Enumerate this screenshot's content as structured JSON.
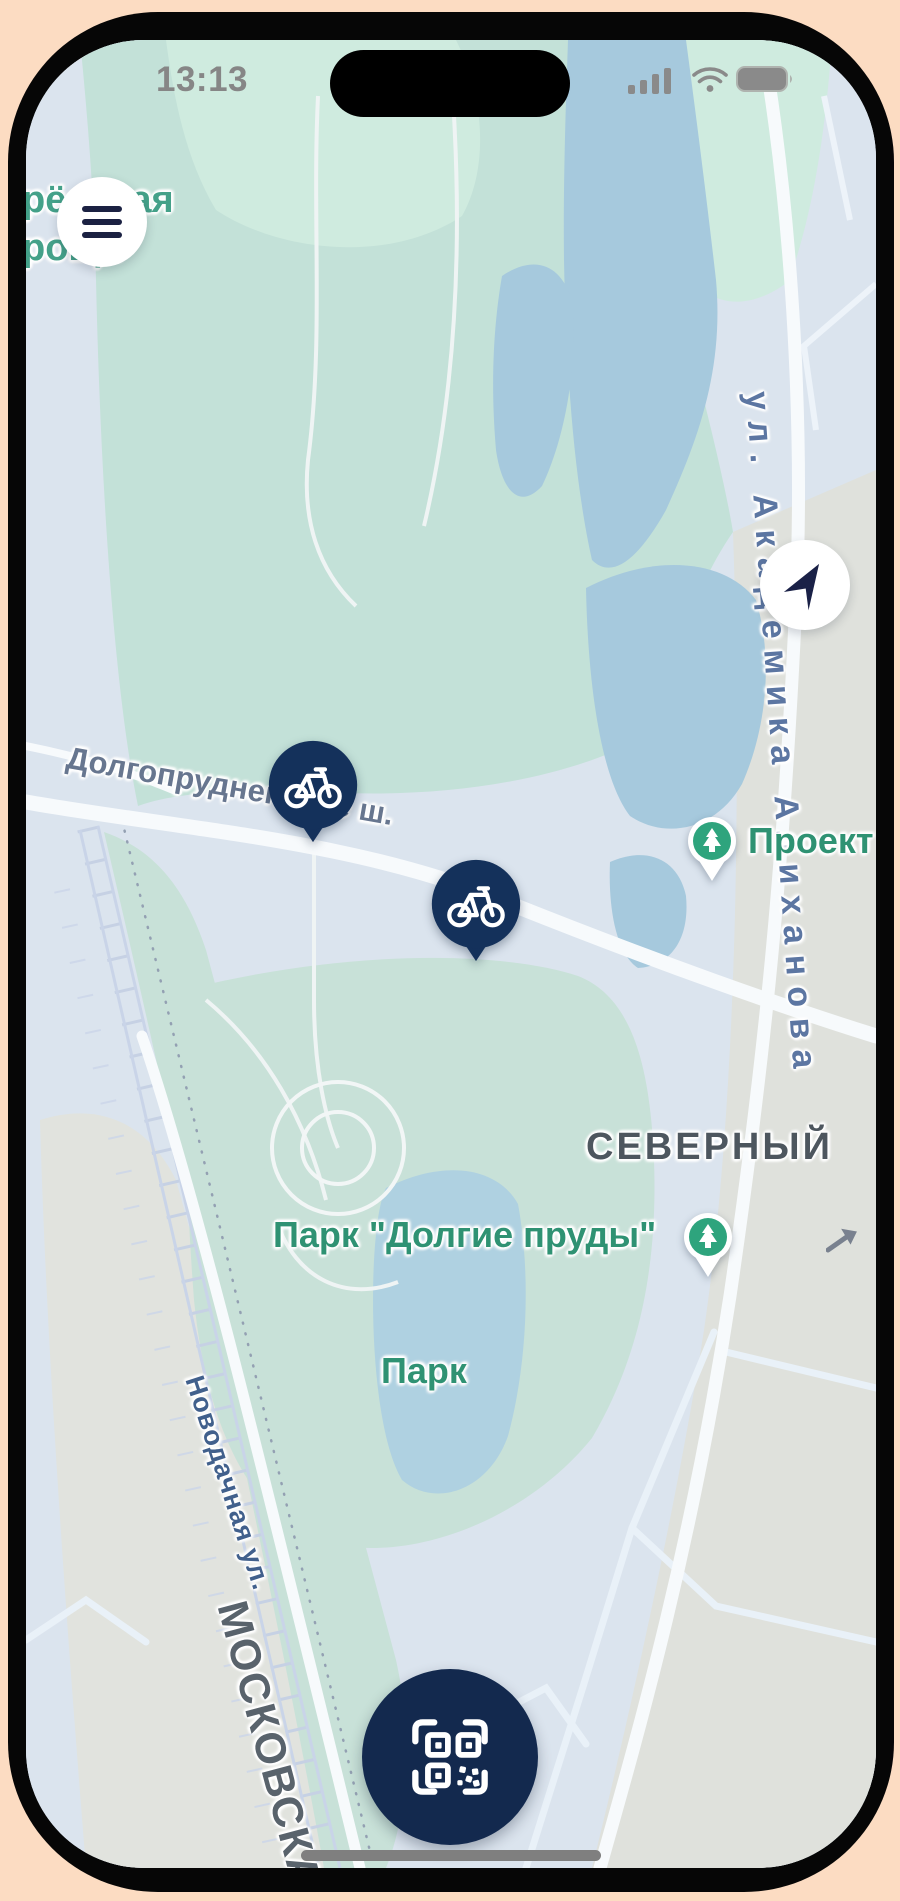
{
  "status_bar": {
    "time": "13:13",
    "icons": [
      "cellular-signal-icon",
      "wifi-icon",
      "battery-icon"
    ]
  },
  "map_labels": {
    "grove_line1": "рёзовая",
    "grove_line2": "роща",
    "dolgoprudnenskoe": "Долгопрудненское ш.",
    "akademika_alikhanova": "ул. Академика Алиханова",
    "severny": "СЕВЕРНЫЙ",
    "park_dolgie_prudy": "Парк \"Долгие пруды\"",
    "park": "Парк",
    "novodachnaya": "Новодачная ул.",
    "moskovskaya": "МОСКОВСКА",
    "proekt": "Проект",
    "google_watermark": "Google"
  },
  "markers": {
    "bike_station_count": 2,
    "park_pin_count": 2,
    "bike_icon": "bicycle-icon",
    "park_icon": "fir-tree-icon",
    "oneway_icon": "oneway-arrow-icon"
  },
  "buttons": {
    "menu_icon": "hamburger-menu-icon",
    "locate_icon": "navigation-arrow-icon",
    "qr_icon": "qr-code-scan-icon"
  },
  "colors": {
    "frame_peach": "#FCDCC2",
    "marker_navy": "#14315B",
    "pin_green": "#2EA47D",
    "label_green": "#2F9273",
    "water_blue": "#A6C9DD",
    "park_teal": "#C3E1D8",
    "urban_gray": "#DFE1DC"
  }
}
